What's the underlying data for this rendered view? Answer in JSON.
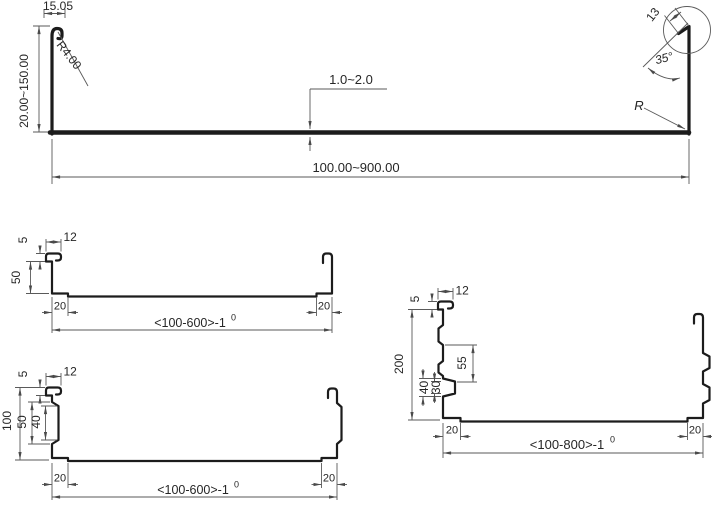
{
  "drawing": {
    "background_color": "#ffffff",
    "profile_line_color": "#1c1c1c",
    "dimension_line_color": "#5a5a5a",
    "top_profile": {
      "lip_width": "15.05",
      "lip_radius": "R4.00",
      "height_range": "20.00~150.00",
      "thickness_range": "1.0~2.0",
      "width_range": "100.00~900.00",
      "hem_length": "13",
      "hem_angle": "35°",
      "corner_radius_label": "R"
    },
    "mid_left_profile": {
      "hook_offset": "5",
      "hook_width": "12",
      "leg_height": "50",
      "left_foot_width": "20",
      "right_foot_width": "20",
      "width_range": "<100-600>-1",
      "width_tolerance_sup": "0"
    },
    "bottom_left_profile": {
      "hook_offset": "5",
      "hook_width": "12",
      "leg_height": "100",
      "rib_outer_height": "50",
      "rib_inner_height": "40",
      "left_foot_width": "20",
      "right_foot_width": "20",
      "width_range": "<100-600>-1",
      "width_tolerance_sup": "0"
    },
    "right_profile": {
      "hook_offset": "5",
      "hook_width": "12",
      "leg_height": "200",
      "rib_spacing": "55",
      "rib_outer_height": "40",
      "rib_inner_height": "30",
      "left_foot_width": "20",
      "right_foot_width": "20",
      "width_range": "<100-800>-1",
      "width_tolerance_sup": "0"
    }
  }
}
